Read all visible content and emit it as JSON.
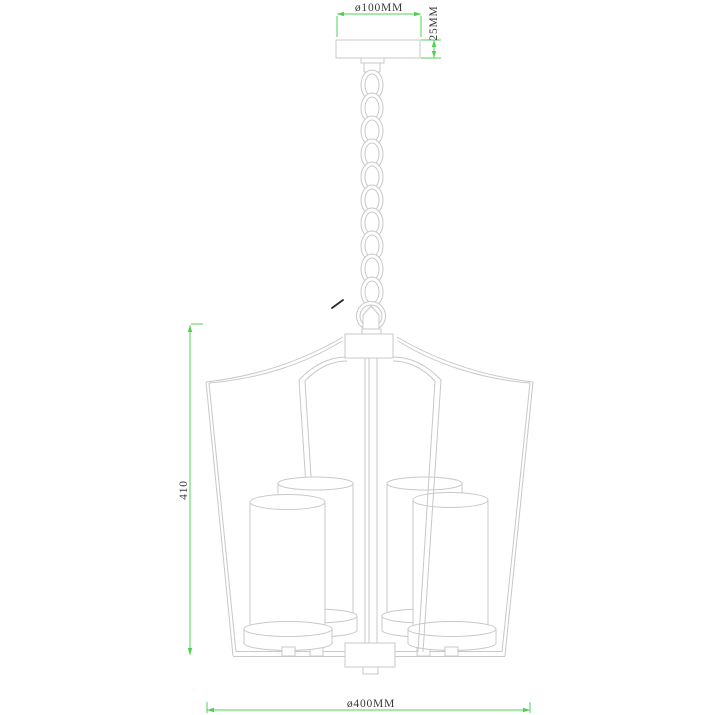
{
  "title": "pendant-chandelier-dimension-drawing",
  "colors": {
    "background": "#ffffff",
    "drawing_line": "#c8c8c8",
    "dimension_line": "#50d050",
    "dimension_text": "#3a3a3a",
    "stray_mark": "#2a2a2a"
  },
  "dimensions": {
    "canopy_diameter_label": "ø100MM",
    "canopy_height_label": "25MM",
    "body_height_label": "410",
    "body_diameter_label": "ø400MM"
  }
}
